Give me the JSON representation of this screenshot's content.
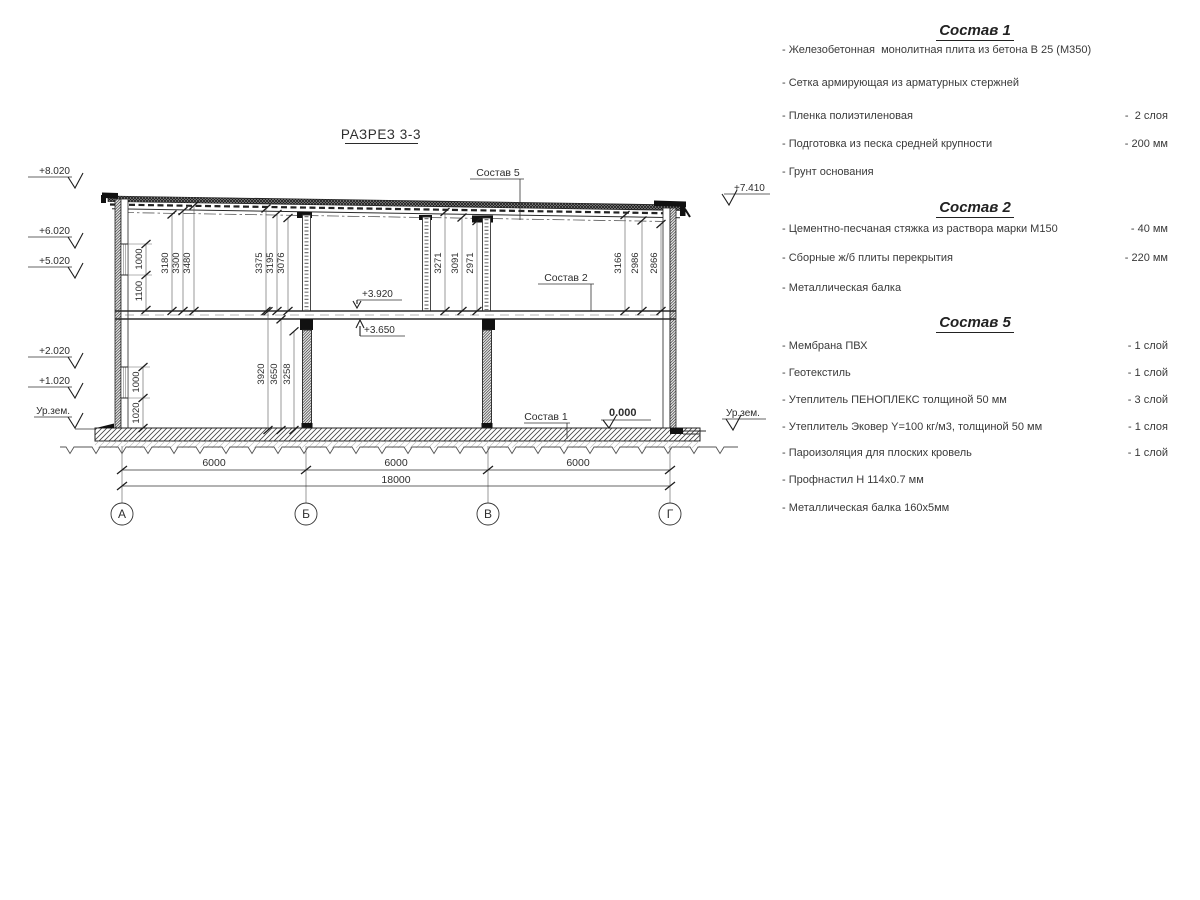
{
  "drawing": {
    "title": "РАЗРЕЗ 3-3",
    "axes": [
      "А",
      "Б",
      "В",
      "Г"
    ],
    "span_dims": [
      "6000",
      "6000",
      "6000"
    ],
    "total_dim": "18000",
    "elev_left": [
      "+8.020",
      "+6.020",
      "+5.020",
      "+2.020",
      "+1.020"
    ],
    "ground_label_left": "Ур.зем.",
    "elev_right": "+7.410",
    "ground_label_right": "Ур.зем.",
    "elev_floor2_top": "+3.920",
    "elev_floor2_bottom": "+3.650",
    "elev_zero": "0.000",
    "leader_roof": "Состав 5",
    "leader_floor": "Состав 2",
    "leader_ground": "Состав 1",
    "height_groups": [
      [
        "3180",
        "3300",
        "3480"
      ],
      [
        "3375",
        "3195",
        "3076"
      ],
      [
        "3271",
        "3091",
        "2971"
      ],
      [
        "3166",
        "2986",
        "2866"
      ]
    ],
    "floor1_heights": [
      "3920",
      "3650",
      "3258"
    ],
    "window_upper": [
      "1000",
      "1100"
    ],
    "window_lower": [
      "1000",
      "1020"
    ]
  },
  "composition_sections": [
    {
      "heading": "Состав 1",
      "items": [
        {
          "text": "- Железобетонная  монолитная плита из бетона В 25 (М350)",
          "qty": ""
        },
        {
          "text": "- Сетка армирующая из арматурных стержней",
          "qty": ""
        },
        {
          "text": "- Пленка полиэтиленовая",
          "qty": "-  2 слоя"
        },
        {
          "text": "- Подготовка из песка средней крупности",
          "qty": "- 200 мм"
        },
        {
          "text": "- Грунт основания",
          "qty": ""
        }
      ]
    },
    {
      "heading": "Состав 2",
      "items": [
        {
          "text": "- Цементно-песчаная стяжка из раствора марки М150",
          "qty": "- 40 мм"
        },
        {
          "text": "- Сборные ж/б плиты перекрытия",
          "qty": "- 220 мм"
        },
        {
          "text": "- Металлическая балка",
          "qty": ""
        }
      ]
    },
    {
      "heading": "Состав 5",
      "items": [
        {
          "text": "- Мембрана ПВХ",
          "qty": "- 1 слой"
        },
        {
          "text": "- Геотекстиль",
          "qty": "- 1 слой"
        },
        {
          "text": "- Утеплитель ПЕНОПЛЕКС толщиной 50 мм",
          "qty": "- 3 слой"
        },
        {
          "text": "- Утеплитель Эковер Y=100 кг/м3, толщиной 50 мм",
          "qty": "- 1 слоя"
        },
        {
          "text": "- Пароизоляция для плоских кровель",
          "qty": "- 1 слой"
        },
        {
          "text": "- Профнастил Н 114х0.7 мм",
          "qty": ""
        },
        {
          "text": "- Металлическая балка 160х5мм",
          "qty": ""
        }
      ]
    }
  ]
}
